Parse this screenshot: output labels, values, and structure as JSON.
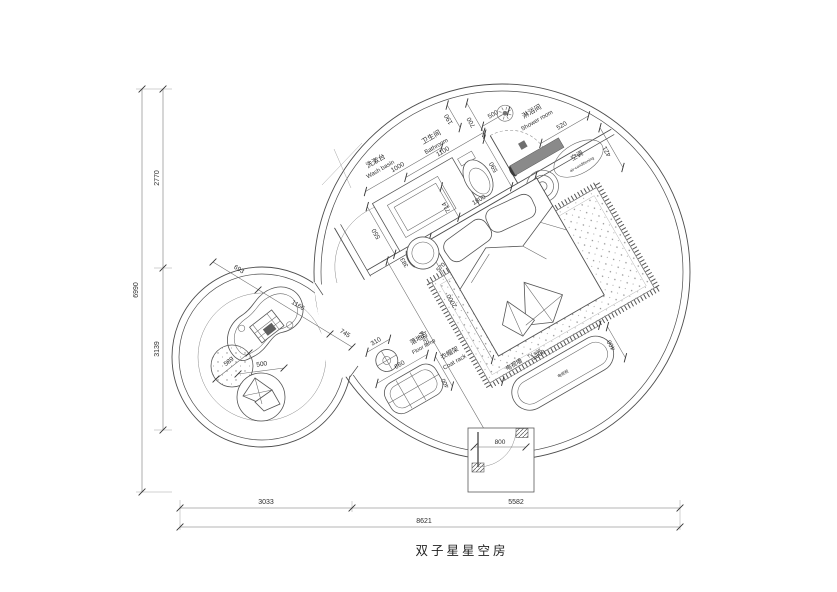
{
  "title": "双子星星空房",
  "dims_left": {
    "total": "6990",
    "upper": "2770",
    "lower": "3139"
  },
  "dims_bottom": {
    "left": "3033",
    "right": "5582",
    "total": "8621"
  },
  "bathroom": {
    "cn": "卫生间",
    "en": "Bathroom",
    "w": "1100",
    "d190": "190",
    "d700": "700",
    "d590": "590",
    "d714": "714"
  },
  "washbasin": {
    "cn": "洗漱台",
    "en": "Wash basin",
    "w": "1000",
    "depth": "550"
  },
  "shower": {
    "cn": "淋浴间",
    "en": "Shower room",
    "d500": "500",
    "d520": "520",
    "d421": "421"
  },
  "ac": {
    "cn": "空调",
    "en": "air-conditioning"
  },
  "bed": {
    "width": "1800",
    "length": "2000",
    "diag": "5584",
    "stool_a": "383",
    "stool_b": "570"
  },
  "floor_lamp": {
    "cn": "落地灯",
    "en": "Floor lamp",
    "d": "310"
  },
  "coat_rack": {
    "cn": "衣帽架",
    "en": "Coat rack",
    "w": "660",
    "d": "400"
  },
  "tv_wall": {
    "cn": "电视墙",
    "en": "TV wall",
    "w": "1200",
    "d": "400",
    "inner": "电视柜"
  },
  "entry": {
    "door": "800"
  },
  "lounge": {
    "d693": "693",
    "d1166": "1166",
    "d745": "745",
    "pouf": "589",
    "chair": "500"
  },
  "colors": {
    "line": "#4d4d4d",
    "dark_fill": "#888888",
    "text": "#2d2d2d"
  }
}
